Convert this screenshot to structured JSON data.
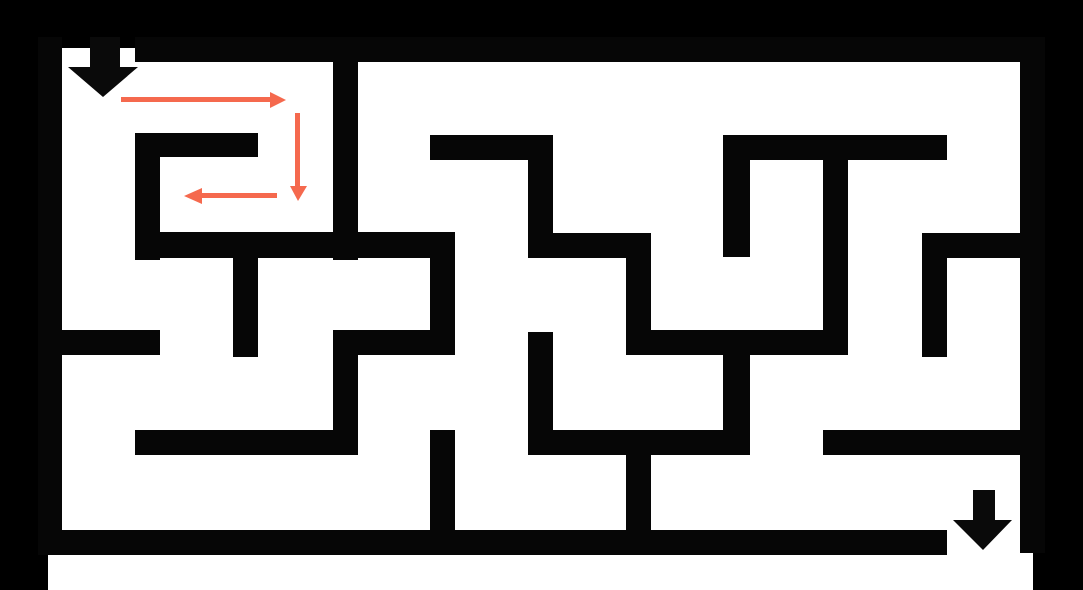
{
  "canvas": {
    "width": 1083,
    "height": 590,
    "background": "#000000"
  },
  "colors": {
    "wall": "#060606",
    "paper": "#ffffff",
    "marker_arrow": "#0a0a0a",
    "path_arrow": "#f5694e"
  },
  "paper_areas": [
    {
      "name": "maze-interior",
      "x": 62,
      "y": 62,
      "w": 958,
      "h": 468
    },
    {
      "name": "entrance-gap",
      "x": 62,
      "y": 48,
      "w": 73,
      "h": 14
    },
    {
      "name": "exit-gap",
      "x": 947,
      "y": 530,
      "w": 73,
      "h": 60
    },
    {
      "name": "bottom-margin-strip",
      "x": 48,
      "y": 553,
      "w": 985,
      "h": 37
    }
  ],
  "walls": [
    {
      "name": "top-border-wall",
      "x": 135,
      "y": 37,
      "w": 910,
      "h": 25
    },
    {
      "name": "left-border-wall",
      "x": 38,
      "y": 37,
      "w": 24,
      "h": 518
    },
    {
      "name": "right-border-wall",
      "x": 1020,
      "y": 37,
      "w": 25,
      "h": 516
    },
    {
      "name": "bottom-border-wall",
      "x": 38,
      "y": 530,
      "w": 909,
      "h": 25
    },
    {
      "name": "spiral-top-wall",
      "x": 135,
      "y": 133,
      "w": 123,
      "h": 24
    },
    {
      "name": "spiral-left-wall",
      "x": 135,
      "y": 133,
      "w": 25,
      "h": 127
    },
    {
      "name": "spiral-bottom-wall",
      "x": 135,
      "y": 232,
      "w": 320,
      "h": 26
    },
    {
      "name": "col3-upper-wall",
      "x": 333,
      "y": 60,
      "w": 25,
      "h": 200
    },
    {
      "name": "col2-stub-wall",
      "x": 233,
      "y": 258,
      "w": 25,
      "h": 99
    },
    {
      "name": "step1-top-wall",
      "x": 430,
      "y": 135,
      "w": 123,
      "h": 25
    },
    {
      "name": "step1-right-wall",
      "x": 528,
      "y": 135,
      "w": 25,
      "h": 123
    },
    {
      "name": "step2-top-wall",
      "x": 528,
      "y": 233,
      "w": 123,
      "h": 25
    },
    {
      "name": "step2-right-wall",
      "x": 626,
      "y": 233,
      "w": 25,
      "h": 122
    },
    {
      "name": "row3-mid-wall",
      "x": 626,
      "y": 330,
      "w": 222,
      "h": 25
    },
    {
      "name": "col8-wall",
      "x": 823,
      "y": 160,
      "w": 25,
      "h": 195
    },
    {
      "name": "row1-right-wall",
      "x": 723,
      "y": 135,
      "w": 224,
      "h": 25
    },
    {
      "name": "col7-stub-wall",
      "x": 723,
      "y": 160,
      "w": 27,
      "h": 97
    },
    {
      "name": "row3-left-wall",
      "x": 38,
      "y": 330,
      "w": 122,
      "h": 25
    },
    {
      "name": "row3-col3-wall",
      "x": 333,
      "y": 330,
      "w": 122,
      "h": 25
    },
    {
      "name": "col4-mid-wall",
      "x": 430,
      "y": 258,
      "w": 25,
      "h": 97
    },
    {
      "name": "col3-lower-wall",
      "x": 333,
      "y": 330,
      "w": 25,
      "h": 125
    },
    {
      "name": "row4-left-wall",
      "x": 135,
      "y": 430,
      "w": 223,
      "h": 25
    },
    {
      "name": "col5-lower-wall",
      "x": 528,
      "y": 332,
      "w": 25,
      "h": 123
    },
    {
      "name": "row4-mid-wall",
      "x": 528,
      "y": 430,
      "w": 222,
      "h": 25
    },
    {
      "name": "col7-lower-wall",
      "x": 723,
      "y": 355,
      "w": 27,
      "h": 100
    },
    {
      "name": "col6-bottom-wall",
      "x": 626,
      "y": 455,
      "w": 25,
      "h": 78
    },
    {
      "name": "col4-bottom-wall",
      "x": 430,
      "y": 430,
      "w": 25,
      "h": 103
    },
    {
      "name": "row2-right-wall",
      "x": 922,
      "y": 233,
      "w": 123,
      "h": 25
    },
    {
      "name": "col9-stub-wall",
      "x": 922,
      "y": 258,
      "w": 25,
      "h": 99
    },
    {
      "name": "row4-right-wall",
      "x": 823,
      "y": 430,
      "w": 222,
      "h": 25
    }
  ],
  "arrows": [
    {
      "name": "entrance-arrow-icon",
      "role": "marker",
      "points": [
        [
          90,
          37
        ],
        [
          120,
          37
        ],
        [
          120,
          67
        ],
        [
          138,
          67
        ],
        [
          103,
          97
        ],
        [
          68,
          67
        ],
        [
          90,
          67
        ]
      ]
    },
    {
      "name": "exit-arrow-icon",
      "role": "marker",
      "points": [
        [
          973,
          490
        ],
        [
          995,
          490
        ],
        [
          995,
          520
        ],
        [
          1012,
          520
        ],
        [
          983,
          550
        ],
        [
          953,
          520
        ],
        [
          973,
          520
        ]
      ]
    },
    {
      "name": "path-arrow-right-icon",
      "role": "path",
      "points": [
        [
          121,
          97
        ],
        [
          270,
          97
        ],
        [
          270,
          92
        ],
        [
          286,
          100
        ],
        [
          270,
          108
        ],
        [
          270,
          102
        ],
        [
          121,
          102
        ]
      ]
    },
    {
      "name": "path-arrow-down-icon",
      "role": "path",
      "points": [
        [
          295,
          113
        ],
        [
          300,
          113
        ],
        [
          300,
          186
        ],
        [
          307,
          186
        ],
        [
          298,
          201
        ],
        [
          290,
          186
        ],
        [
          295,
          186
        ]
      ]
    },
    {
      "name": "path-arrow-left-icon",
      "role": "path",
      "points": [
        [
          277,
          193
        ],
        [
          277,
          198
        ],
        [
          202,
          198
        ],
        [
          202,
          204
        ],
        [
          184,
          196
        ],
        [
          202,
          188
        ],
        [
          202,
          193
        ]
      ]
    }
  ]
}
